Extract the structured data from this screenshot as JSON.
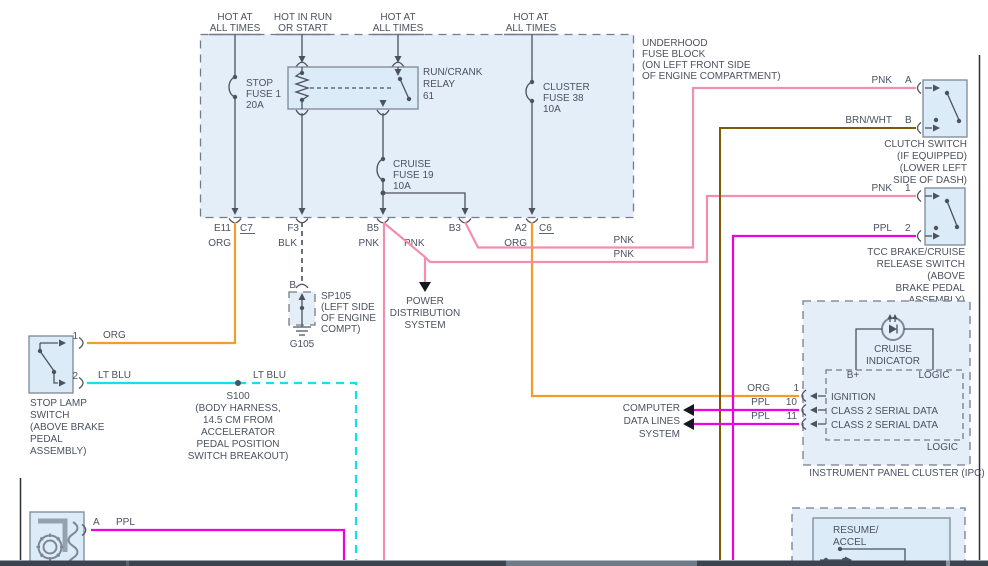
{
  "colors": {
    "org": "#f59b2b",
    "pnk": "#f38fae",
    "ppl": "#ee00e6",
    "ltblu": "#12dff0",
    "brn": "#7c5a08",
    "line": "#4c525e",
    "text": "#4b5260",
    "fill": "#e4eef9",
    "fill2": "#dcebf8",
    "bar": "#3c4452",
    "barlight": "#6f7a88"
  },
  "feeds": {
    "hot_at": "HOT AT",
    "all_times": "ALL TIMES",
    "hot_in_run": "HOT IN RUN",
    "or_start": "OR START"
  },
  "underhood": [
    "UNDERHOOD",
    "FUSE BLOCK",
    "(ON LEFT FRONT SIDE",
    "OF ENGINE COMPARTMENT)"
  ],
  "stop_fuse": [
    "STOP",
    "FUSE 1",
    "20A"
  ],
  "cluster_fuse": [
    "CLUSTER",
    "FUSE 38",
    "10A"
  ],
  "cruise_fuse": [
    "CRUISE",
    "FUSE 19",
    "10A"
  ],
  "relay": [
    "RUN/CRANK",
    "RELAY",
    "61"
  ],
  "pins": {
    "e11": "E11",
    "c7": "C7",
    "f3": "F3",
    "b5": "B5",
    "b3": "B3",
    "a2": "A2",
    "c6": "C6",
    "a": "A",
    "b": "B",
    "p1": "1",
    "p2": "2",
    "p10": "10",
    "p11": "11"
  },
  "wire": {
    "org": "ORG",
    "blk": "BLK",
    "pnk": "PNK",
    "ppl": "PPL",
    "ltblu": "LT BLU",
    "brnwht": "BRN/WHT"
  },
  "sp105": {
    "ref": "SP105",
    "note": [
      "(LEFT SIDE",
      "OF ENGINE",
      "COMPT)"
    ],
    "ground": "G105"
  },
  "power_dist": [
    "POWER",
    "DISTRIBUTION",
    "SYSTEM"
  ],
  "stop_lamp": [
    "STOP LAMP",
    "SWITCH",
    "(ABOVE BRAKE",
    "PEDAL",
    "ASSEMBLY)"
  ],
  "s100": {
    "ref": "S100",
    "note": [
      "(BODY HARNESS,",
      "14.5 CM FROM",
      "ACCELERATOR",
      "PEDAL POSITION",
      "SWITCH BREAKOUT)"
    ]
  },
  "clutch": [
    "CLUTCH SWITCH",
    "(IF EQUIPPED)",
    "(LOWER LEFT",
    "SIDE OF DASH)"
  ],
  "tcc": [
    "TCC BRAKE/CRUISE",
    "RELEASE SWITCH",
    "(ABOVE",
    "BRAKE PEDAL",
    "ASSEMBLY)"
  ],
  "computer": [
    "COMPUTER",
    "DATA LINES",
    "SYSTEM"
  ],
  "ipc": {
    "indicator": [
      "CRUISE",
      "INDICATOR"
    ],
    "b_plus": "B+",
    "logic": "LOGIC",
    "signals": [
      "IGNITION",
      "CLASS 2 SERIAL DATA",
      "CLASS 2 SERIAL DATA"
    ],
    "title": "INSTRUMENT PANEL CLUSTER (IPC)"
  },
  "resume": [
    "RESUME/",
    "ACCEL"
  ]
}
